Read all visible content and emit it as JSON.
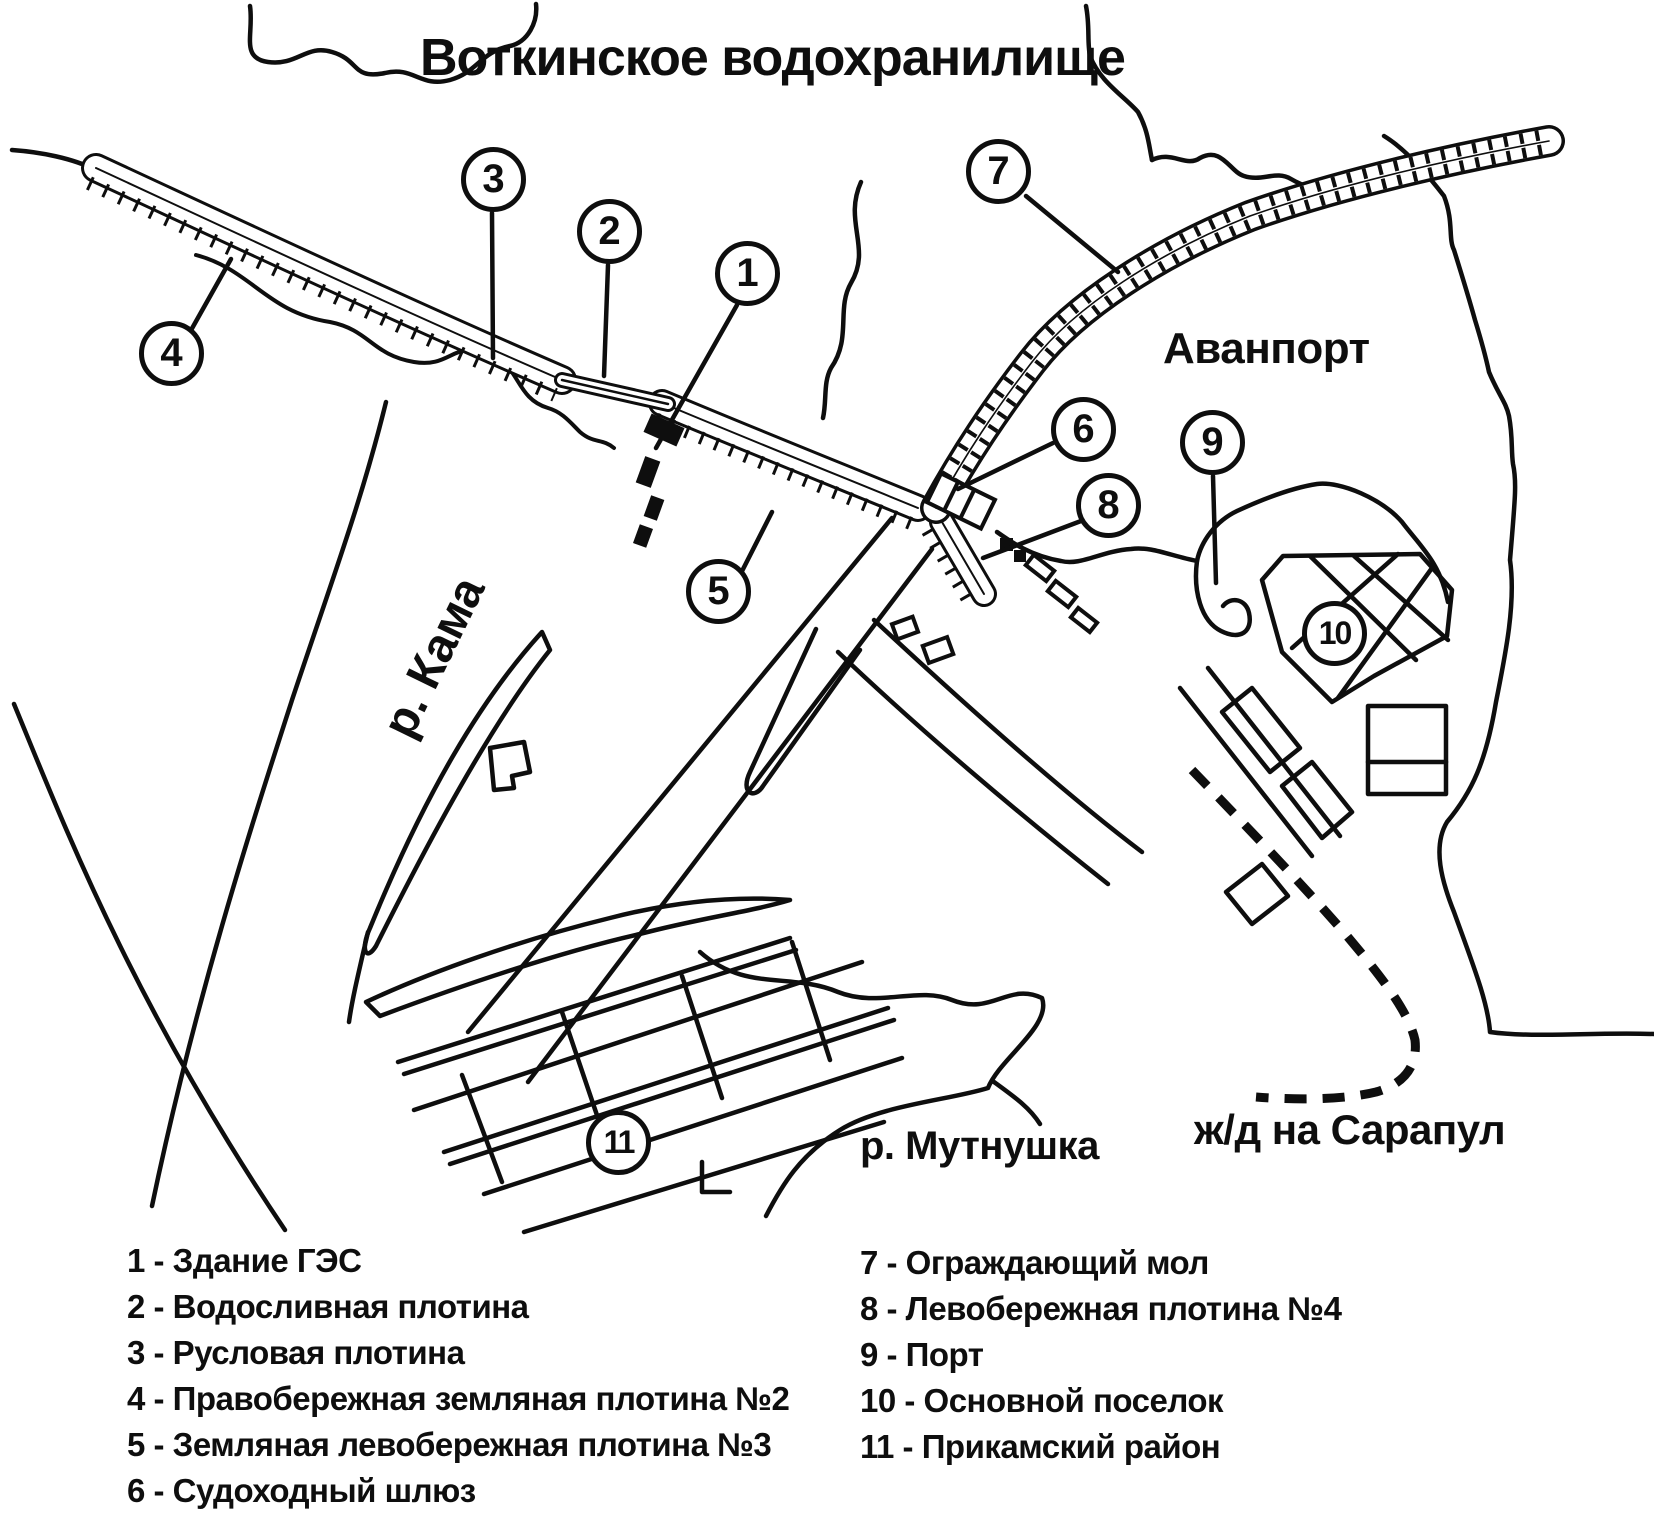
{
  "labels": {
    "title": "Воткинское водохранилище",
    "avanport": "Аванпорт",
    "kama_river": "р. Кама",
    "mutnushka_river": "р. Мутнушка",
    "railway": "ж/д на Сарапул"
  },
  "markers": [
    "1",
    "2",
    "3",
    "4",
    "5",
    "6",
    "7",
    "8",
    "9",
    "10",
    "11"
  ],
  "legend": {
    "left": [
      "1 - Здание ГЭС",
      "2 - Водосливная плотина",
      "3 - Русловая плотина",
      "4 - Правобережная земляная плотина №2",
      "5 - Земляная левобережная плотина №3",
      "6 - Судоходный шлюз"
    ],
    "right": [
      "7 - Ограждающий мол",
      "8 - Левобережная плотина №4",
      "9 - Порт",
      "10 - Основной поселок",
      "11 - Прикамский район"
    ]
  },
  "colors": {
    "ink": "#0e0e0e",
    "paper": "#ffffff"
  }
}
